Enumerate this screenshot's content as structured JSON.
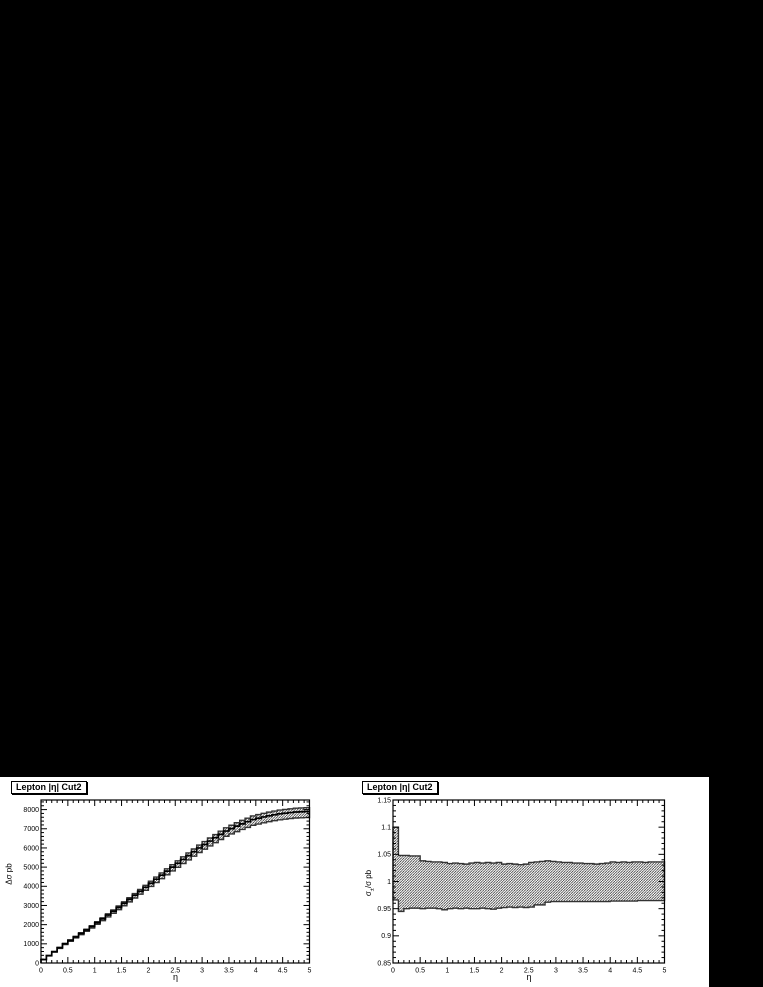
{
  "style": {
    "page_background": "#000000",
    "canvas_background": "#ffffff",
    "ink": "#000000",
    "band_edge": "#333333",
    "hatch": "#000000"
  },
  "chart_data": [
    {
      "type": "area",
      "title": "Lepton |η| Cut2",
      "xlabel": "η",
      "ylabel": "Δσ pb",
      "legend": "none",
      "grid": "off",
      "xlim": [
        0,
        5
      ],
      "ylim": [
        0,
        8500
      ],
      "x_tick_values": [
        0,
        0.5,
        1,
        1.5,
        2,
        2.5,
        3,
        3.5,
        4,
        4.5,
        5
      ],
      "x_tick_labels": [
        "0",
        "0.5",
        "1",
        "1.5",
        "2",
        "2.5",
        "3",
        "3.5",
        "4",
        "4.5",
        "5"
      ],
      "x_minor_step": 0.1,
      "y_tick_values": [
        0,
        1000,
        2000,
        3000,
        4000,
        5000,
        6000,
        7000,
        8000
      ],
      "y_tick_labels": [
        "0",
        "1000",
        "2000",
        "3000",
        "4000",
        "5000",
        "6000",
        "7000",
        "8000"
      ],
      "y_minor_step": 200,
      "bin_start": 0,
      "bin_width": 0.1,
      "band_style": "hatched-diagonal",
      "series": [
        {
          "name": "central",
          "values": [
            180,
            385,
            590,
            795,
            1000,
            1180,
            1360,
            1540,
            1720,
            1900,
            2100,
            2300,
            2500,
            2700,
            2900,
            3110,
            3320,
            3530,
            3740,
            3950,
            4160,
            4370,
            4580,
            4790,
            5000,
            5200,
            5400,
            5600,
            5800,
            6000,
            6180,
            6360,
            6536,
            6708,
            6880,
            7008,
            7136,
            7256,
            7368,
            7480,
            7548,
            7616,
            7676,
            7728,
            7780,
            7812,
            7844,
            7876,
            7888,
            7900
          ]
        },
        {
          "name": "upper",
          "values": [
            185,
            395,
            605,
            815,
            1025,
            1210,
            1394,
            1579,
            1763,
            1948,
            2153,
            2358,
            2563,
            2768,
            2973,
            3188,
            3403,
            3618,
            3834,
            4049,
            4264,
            4479,
            4695,
            4910,
            5125,
            5330,
            5535,
            5740,
            5945,
            6150,
            6335,
            6519,
            6699,
            6876,
            7052,
            7183,
            7314,
            7437,
            7552,
            7667,
            7737,
            7806,
            7868,
            7921,
            7975,
            8007,
            8040,
            8073,
            8085,
            8098
          ]
        },
        {
          "name": "lower",
          "values": [
            173,
            370,
            566,
            763,
            960,
            1133,
            1306,
            1478,
            1651,
            1824,
            2016,
            2208,
            2400,
            2592,
            2784,
            2986,
            3187,
            3389,
            3590,
            3792,
            3994,
            4195,
            4397,
            4598,
            4800,
            4992,
            5184,
            5376,
            5568,
            5760,
            5933,
            6106,
            6275,
            6440,
            6605,
            6728,
            6851,
            6966,
            7073,
            7181,
            7246,
            7311,
            7369,
            7419,
            7469,
            7500,
            7530,
            7561,
            7573,
            7584
          ]
        }
      ]
    },
    {
      "type": "area",
      "title": "Lepton |η| Cut2",
      "xlabel": "η",
      "ylabel": "σ±/σ pb",
      "ylabel_parts": {
        "base": "σ",
        "sub": "±",
        "rest": "/σ pb"
      },
      "legend": "none",
      "grid": "off",
      "xlim": [
        0,
        5
      ],
      "ylim": [
        0.85,
        1.15
      ],
      "x_tick_values": [
        0,
        0.5,
        1,
        1.5,
        2,
        2.5,
        3,
        3.5,
        4,
        4.5,
        5
      ],
      "x_tick_labels": [
        "0",
        "0.5",
        "1",
        "1.5",
        "2",
        "2.5",
        "3",
        "3.5",
        "4",
        "4.5",
        "5"
      ],
      "x_minor_step": 0.1,
      "y_tick_values": [
        0.85,
        0.9,
        0.95,
        1,
        1.05,
        1.1,
        1.15
      ],
      "y_tick_labels": [
        "0.85",
        "0.9",
        "0.95",
        "1",
        "1.05",
        "1.1",
        "1.15"
      ],
      "y_minor_step": 0.01,
      "bin_start": 0,
      "bin_width": 0.1,
      "band_style": "hatched-diagonal",
      "series": [
        {
          "name": "upper",
          "values": [
            1.1,
            1.048,
            1.048,
            1.047,
            1.047,
            1.038,
            1.037,
            1.036,
            1.036,
            1.035,
            1.033,
            1.034,
            1.033,
            1.032,
            1.034,
            1.035,
            1.034,
            1.035,
            1.034,
            1.035,
            1.032,
            1.033,
            1.032,
            1.031,
            1.032,
            1.035,
            1.036,
            1.037,
            1.038,
            1.037,
            1.036,
            1.035,
            1.035,
            1.034,
            1.034,
            1.033,
            1.033,
            1.032,
            1.033,
            1.034,
            1.036,
            1.035,
            1.036,
            1.035,
            1.036,
            1.036,
            1.035,
            1.036,
            1.036,
            1.036
          ]
        },
        {
          "name": "lower",
          "values": [
            0.966,
            0.945,
            0.95,
            0.951,
            0.951,
            0.95,
            0.951,
            0.951,
            0.95,
            0.948,
            0.95,
            0.951,
            0.95,
            0.951,
            0.95,
            0.95,
            0.951,
            0.95,
            0.949,
            0.951,
            0.952,
            0.953,
            0.952,
            0.953,
            0.952,
            0.953,
            0.957,
            0.957,
            0.962,
            0.963,
            0.963,
            0.963,
            0.963,
            0.963,
            0.963,
            0.963,
            0.963,
            0.963,
            0.963,
            0.963,
            0.964,
            0.964,
            0.964,
            0.964,
            0.964,
            0.965,
            0.965,
            0.965,
            0.965,
            0.965
          ]
        }
      ]
    }
  ]
}
